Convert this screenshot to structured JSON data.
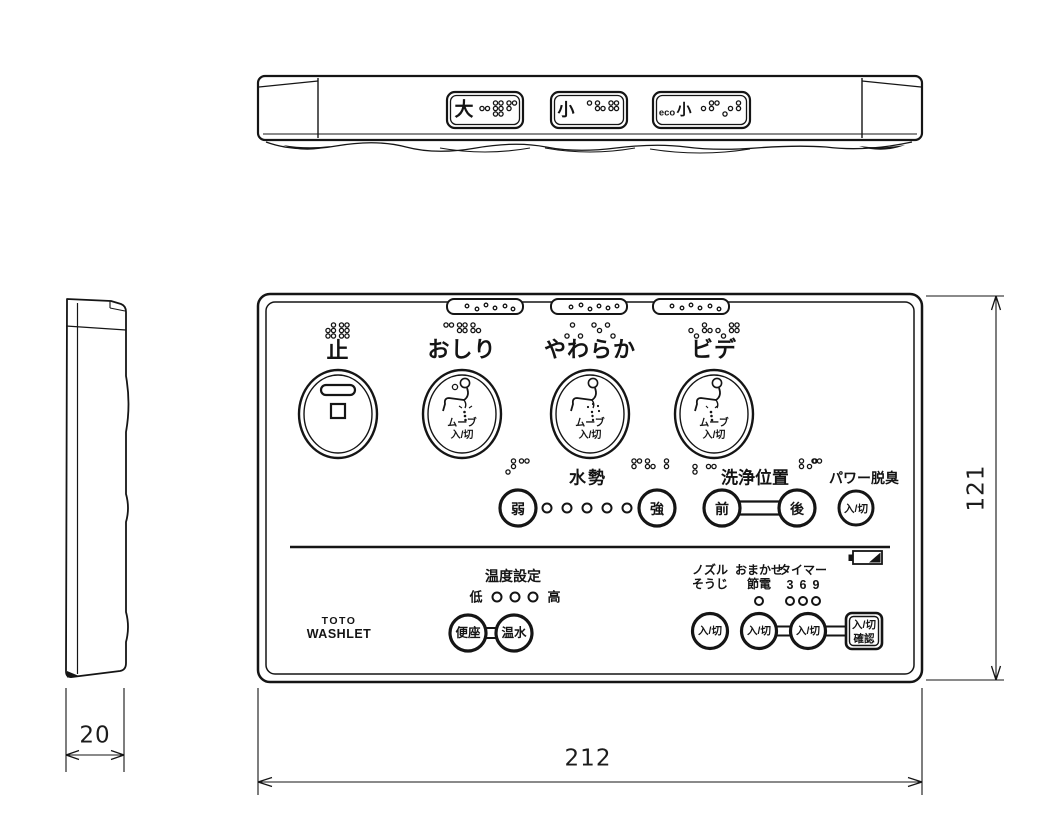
{
  "top_view": {
    "flush_buttons": [
      {
        "label": "大",
        "braille": [
          [
            2,
            5
          ],
          [
            1,
            2,
            3,
            4,
            5,
            6
          ],
          [
            1,
            2,
            4
          ]
        ]
      },
      {
        "label": "小",
        "braille": [
          [
            4
          ],
          [
            1,
            2,
            5
          ],
          [
            1,
            2,
            4,
            5
          ]
        ]
      },
      {
        "label_prefix": "eco",
        "label": "小",
        "braille": [
          [
            5
          ],
          [
            1,
            2,
            4
          ],
          [
            3,
            5
          ],
          [
            1,
            2
          ]
        ]
      }
    ]
  },
  "front_view": {
    "main_buttons": [
      {
        "label": "止",
        "braille": [
          [
            2,
            3,
            4,
            5,
            6
          ],
          [
            1,
            2,
            3,
            4,
            5,
            6
          ]
        ]
      },
      {
        "label": "おしり",
        "sub1": "ムーブ",
        "sub2": "入/切",
        "braille": [
          [
            1,
            4
          ],
          [
            1,
            2,
            4,
            5
          ],
          [
            1,
            2,
            5
          ]
        ]
      },
      {
        "label": "やわらか",
        "sub1": "ムーブ",
        "sub2": "入/切",
        "braille": [
          [
            3,
            4
          ],
          [
            3
          ],
          [
            1,
            5
          ],
          [
            1,
            6
          ]
        ]
      },
      {
        "label": "ビデ",
        "sub1": "ムーブ",
        "sub2": "入/切",
        "braille": [
          [
            2,
            6
          ],
          [
            1,
            2,
            5
          ],
          [
            2,
            6
          ],
          [
            1,
            2,
            4,
            5
          ]
        ]
      }
    ],
    "water_pressure": {
      "label": "水勢",
      "weak": "弱",
      "strong": "強",
      "indicator_dots": 5,
      "braille_left": [
        [
          3,
          4,
          5
        ],
        [
          1,
          4
        ]
      ],
      "braille_right": [
        [
          1,
          2,
          4
        ],
        [
          1,
          2,
          5
        ],
        [
          4,
          5
        ]
      ]
    },
    "wash_position": {
      "label": "洗浄位置",
      "front": "前",
      "back": "後",
      "braille_left": [
        [
          2,
          3
        ],
        [
          2,
          5
        ]
      ],
      "braille_right": [
        [
          4,
          5
        ],
        [
          2,
          4
        ]
      ]
    },
    "deodorizer": {
      "label": "パワー脱臭",
      "button": "入/切",
      "braille": [
        [
          1,
          4
        ]
      ]
    },
    "temperature": {
      "label": "温度設定",
      "low": "低",
      "high": "高",
      "indicator_dots": 3,
      "seat_button": "便座",
      "water_button": "温水"
    },
    "nozzle_clean": {
      "label1": "ノズル",
      "label2": "そうじ",
      "button": "入/切"
    },
    "energy_save": {
      "label1": "おまかせ",
      "label2": "節電",
      "indicator_dots": 1,
      "button": "入/切"
    },
    "timer": {
      "label1": "タイマー",
      "values": [
        "3",
        "6",
        "9"
      ],
      "indicator_dots": 3,
      "button": "入/切"
    },
    "confirm_button": {
      "line1": "入/切",
      "line2": "確認"
    },
    "logo": {
      "line1": "TOTO",
      "line2": "WASHLET"
    },
    "battery_icon": "battery"
  },
  "dimensions": {
    "width_mm": "212",
    "height_mm": "121",
    "depth_mm": "20"
  }
}
